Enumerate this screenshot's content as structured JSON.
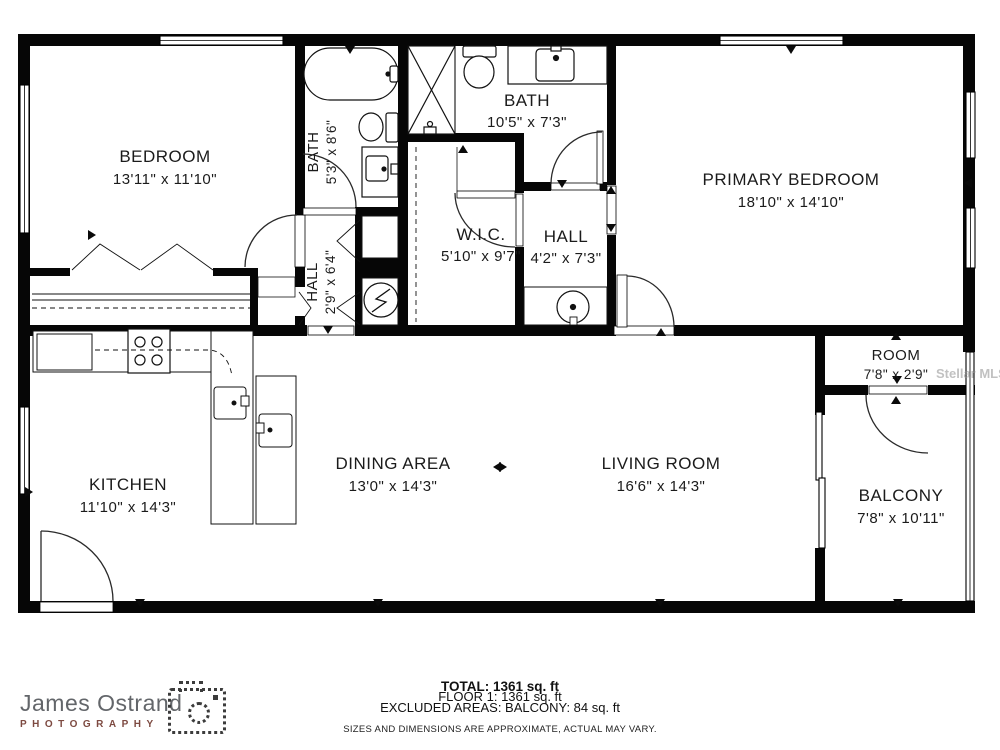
{
  "floorplan": {
    "rooms": {
      "bedroom": {
        "name": "BEDROOM",
        "dims": "13'11\" x 11'10\""
      },
      "bath1": {
        "name": "BATH",
        "dims": "5'3\" x 8'6\""
      },
      "bath2": {
        "name": "BATH",
        "dims": "10'5\" x 7'3\""
      },
      "primary_bedroom": {
        "name": "PRIMARY BEDROOM",
        "dims": "18'10\" x 14'10\""
      },
      "wic": {
        "name": "W.I.C.",
        "dims": "5'10\" x 9'7\""
      },
      "hall1": {
        "name": "HALL",
        "dims": "4'2\" x 7'3\""
      },
      "hall2": {
        "name": "HALL",
        "dims": "2'9\" x 6'4\""
      },
      "kitchen": {
        "name": "KITCHEN",
        "dims": "11'10\" x 14'3\""
      },
      "dining": {
        "name": "DINING AREA",
        "dims": "13'0\" x 14'3\""
      },
      "living": {
        "name": "LIVING ROOM",
        "dims": "16'6\" x 14'3\""
      },
      "room": {
        "name": "ROOM",
        "dims": "7'8\" x 2'9\""
      },
      "balcony": {
        "name": "BALCONY",
        "dims": "7'8\" x 10'11\""
      }
    }
  },
  "summary": {
    "total": "TOTAL: 1361 sq. ft",
    "floor1": "FLOOR 1: 1361 sq. ft",
    "excluded": "EXCLUDED AREAS: BALCONY: 84 sq. ft",
    "disclaimer": "SIZES AND DIMENSIONS ARE APPROXIMATE, ACTUAL MAY VARY."
  },
  "branding": {
    "photographer": "James Ostrand",
    "studio": "PHOTOGRAPHY",
    "accent_color": "#7d4a41",
    "text_color": "#63666a"
  },
  "watermark": {
    "text": "Stellar MLS"
  }
}
